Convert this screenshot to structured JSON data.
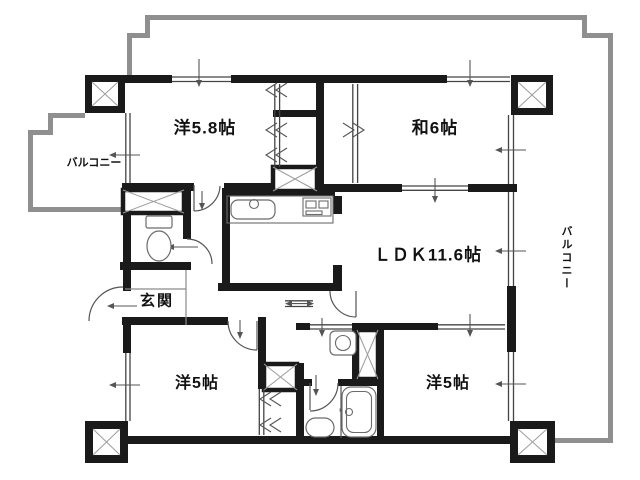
{
  "plan": {
    "rooms": {
      "western_58": {
        "label": "洋5.8帖"
      },
      "japanese_6": {
        "label": "和6帖"
      },
      "ldk": {
        "label": "ＬＤＫ11.6帖"
      },
      "western_5_left": {
        "label": "洋5帖"
      },
      "western_5_right": {
        "label": "洋5帖"
      },
      "genkan": {
        "label": "玄関"
      }
    },
    "balconies": {
      "left": {
        "label": "バルコニー"
      },
      "right": {
        "label": "バルコニー"
      }
    },
    "colors": {
      "wall": "#1a1a1a",
      "balcony_outline": "#8f8f8f",
      "window_line": "#444444",
      "detail_line": "#555555",
      "fixture_line": "#6b6b6b",
      "background": "#ffffff"
    }
  }
}
